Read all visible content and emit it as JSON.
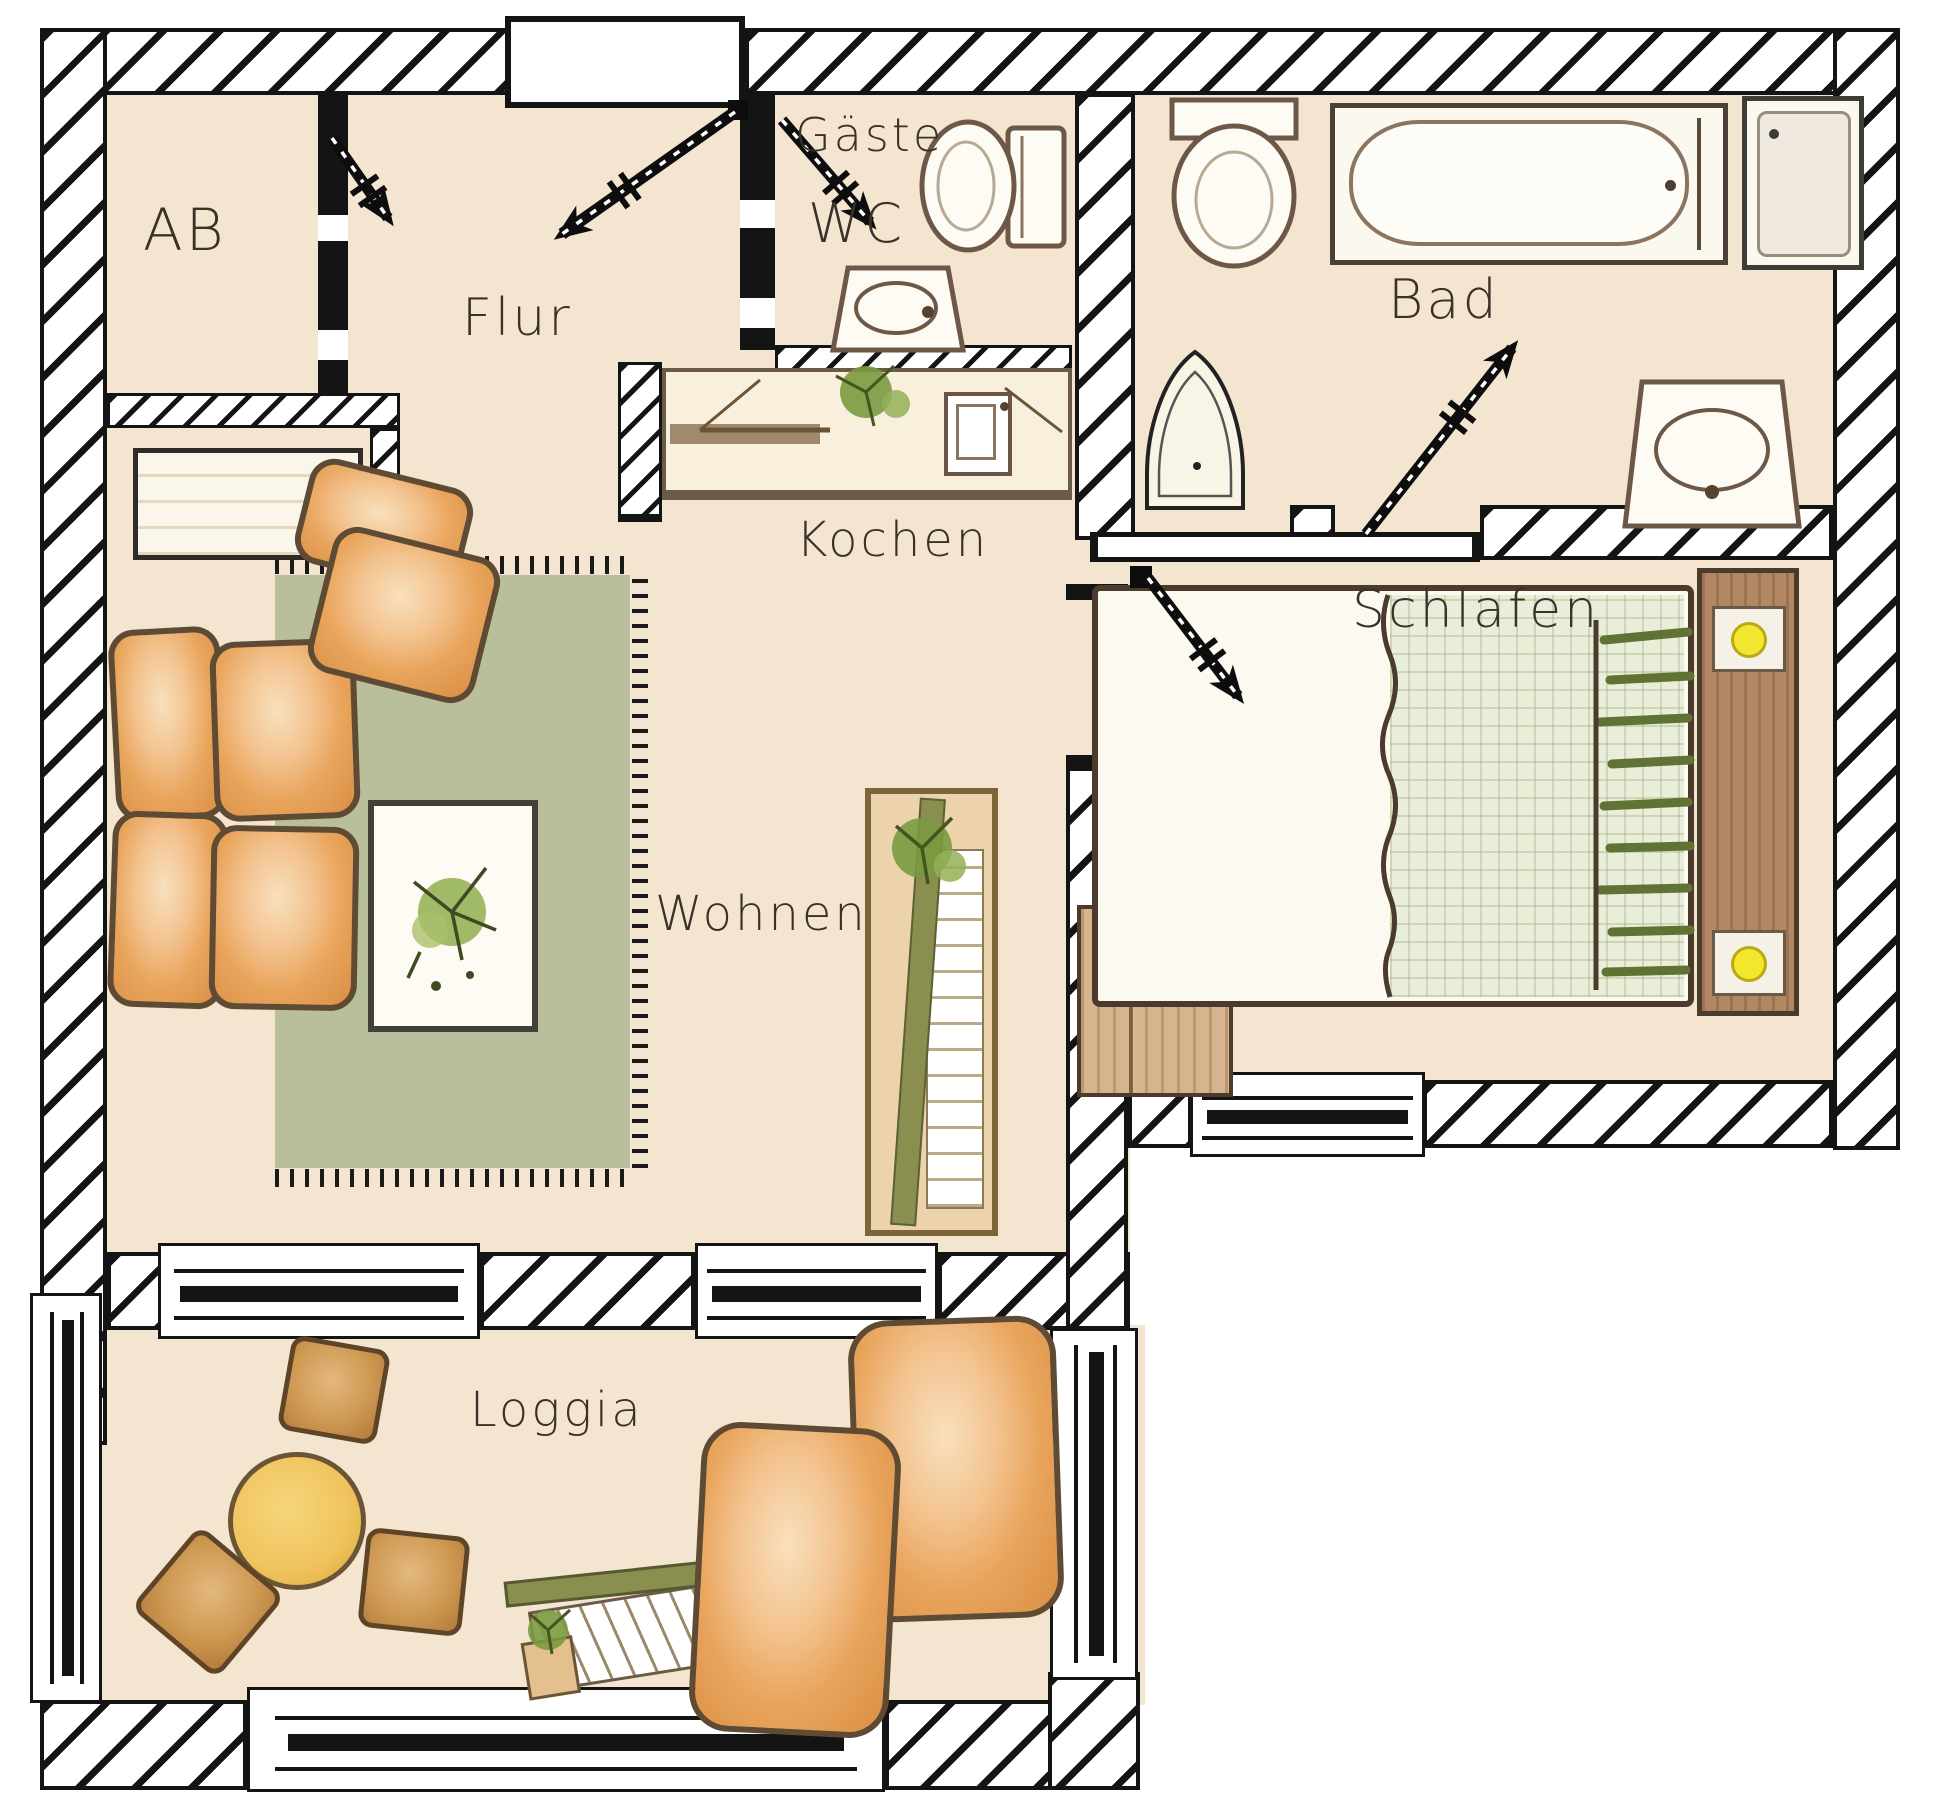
{
  "labels": {
    "ab": "AB",
    "flur": "Flur",
    "gaeste": "Gäste",
    "wc": "WC",
    "bad": "Bad",
    "kochen": "Kochen",
    "wohnen": "Wohnen",
    "schlafen": "Schlafen",
    "loggia": "Loggia"
  },
  "palette": {
    "floor": "#f4e5d0",
    "wall_line": "#141414",
    "rug_green": "#b9bf9a",
    "cushion_orange": "#e9a45b",
    "outline_brown": "#5f4b34",
    "wood_cream": "#fbf6ea",
    "table_yellow": "#eab94f",
    "olive_bar": "#8a8f4f",
    "bed_green": "#e9eeda",
    "pillow_strokes": "#5f7434",
    "headboard_brown": "#b28763",
    "lamp_yellow": "#f2e62e",
    "fixture_outline": "#6d5848"
  }
}
